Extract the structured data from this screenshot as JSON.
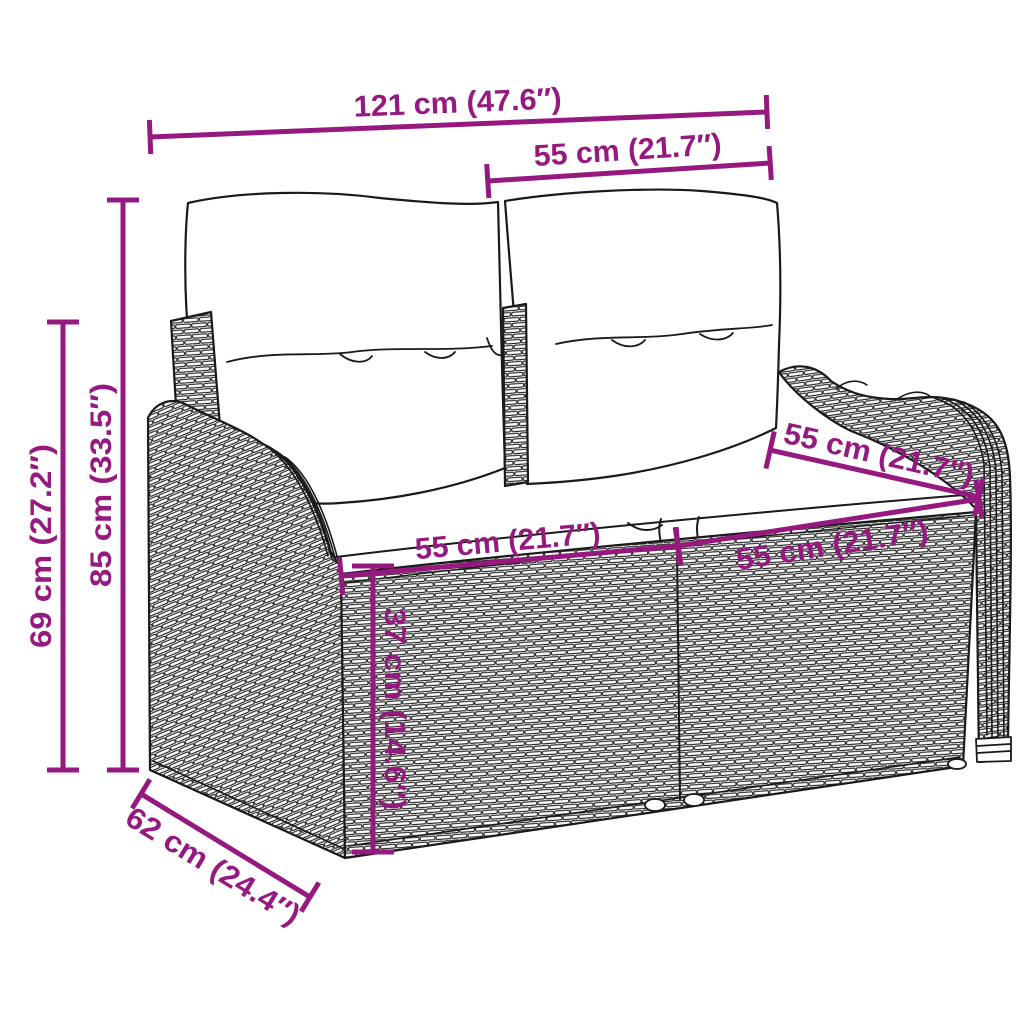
{
  "diagram": {
    "kind": "product-dimension-diagram",
    "subject": "poly-rattan 2-seater garden bench with back and seat cushions",
    "accent_color": "#96197F",
    "line_color": "#1a1a1a",
    "background_color": "#ffffff",
    "dimensions": {
      "total_width": "121 cm (47.6″)",
      "back_section_width": "55 cm (21.7″)",
      "total_height": "85 cm (33.5″)",
      "armrest_height": "69 cm (27.2″)",
      "depth": "62 cm (24.4″)",
      "seat_height": "37 cm (14.6″)",
      "seat_width_left": "55 cm (21.7″)",
      "seat_width_right": "55 cm (21.7″)",
      "seat_depth": "55 cm (21.7″)"
    }
  }
}
